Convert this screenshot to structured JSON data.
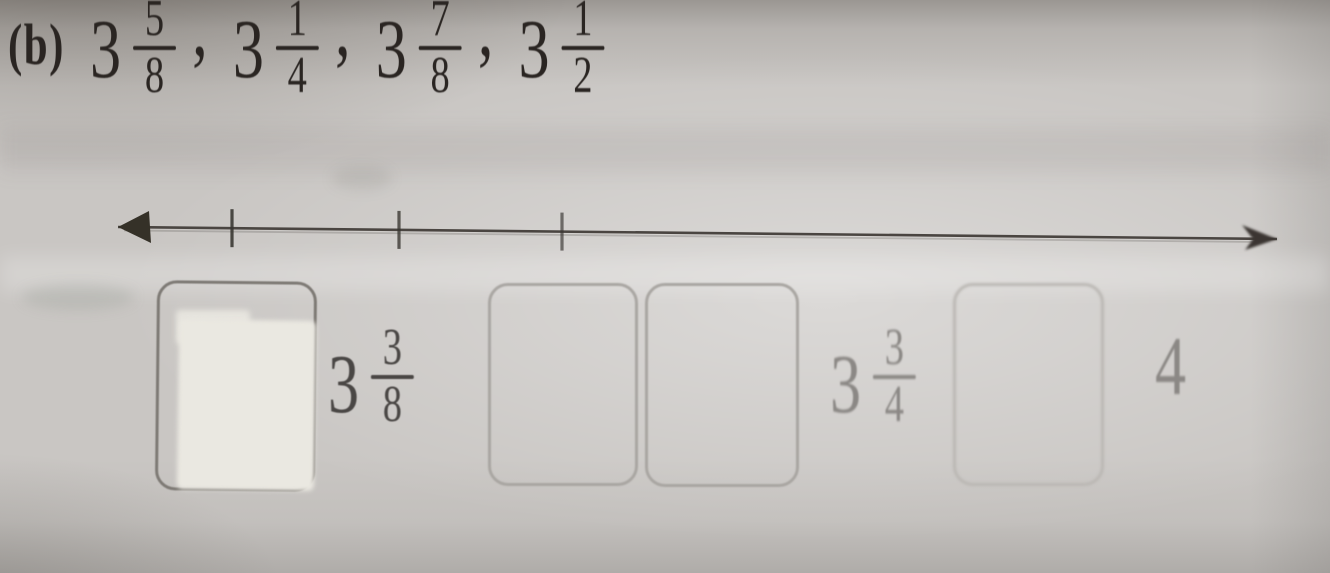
{
  "colors": {
    "paper": "#c9c6c3",
    "ink": "#2a2522",
    "line": "#4a4541",
    "tick_rgb": "55,52,48",
    "label_dark": "#4a4745",
    "label_faint": "#8b8885",
    "whiteout": "#eae8e1"
  },
  "problem": {
    "label": "(b)",
    "separator": ",",
    "sequence": [
      {
        "whole": "3",
        "num": "5",
        "den": "8"
      },
      {
        "whole": "3",
        "num": "1",
        "den": "4"
      },
      {
        "whole": "3",
        "num": "7",
        "den": "8"
      },
      {
        "whole": "3",
        "num": "1",
        "den": "2"
      }
    ]
  },
  "number_line": {
    "x_start": 118,
    "y_start": 227,
    "x_end": 1277,
    "y_end": 239,
    "tick_half_length": 19,
    "ticks": [
      {
        "x": 232,
        "shade": 0.88
      },
      {
        "x": 399,
        "shade": 0.78
      },
      {
        "x": 562,
        "shade": 0.66
      },
      {
        "x": 722,
        "shade": 0.42
      },
      {
        "x": 876,
        "shade": 0.38
      },
      {
        "x": 1022,
        "shade": 0.33
      },
      {
        "x": 1170,
        "shade": 0.3
      }
    ]
  },
  "answers": {
    "items": [
      {
        "type": "box",
        "x": 156,
        "y": 281,
        "w": 154,
        "h": 204,
        "shade": "dark",
        "whiteout": true
      },
      {
        "type": "fraction",
        "x": 328,
        "y": 300,
        "whole": "3",
        "num": "3",
        "den": "8",
        "tone": "dark"
      },
      {
        "type": "box",
        "x": 488,
        "y": 283,
        "w": 144,
        "h": 197,
        "shade": "light"
      },
      {
        "type": "box",
        "x": 645,
        "y": 283,
        "w": 148,
        "h": 198,
        "shade": "light"
      },
      {
        "type": "fraction",
        "x": 830,
        "y": 300,
        "whole": "3",
        "num": "3",
        "den": "4",
        "tone": "faint"
      },
      {
        "type": "box",
        "x": 953,
        "y": 283,
        "w": 145,
        "h": 197,
        "shade": "faint"
      },
      {
        "type": "number",
        "x": 1155,
        "y": 325,
        "value": "4",
        "tone": "faint"
      }
    ]
  }
}
